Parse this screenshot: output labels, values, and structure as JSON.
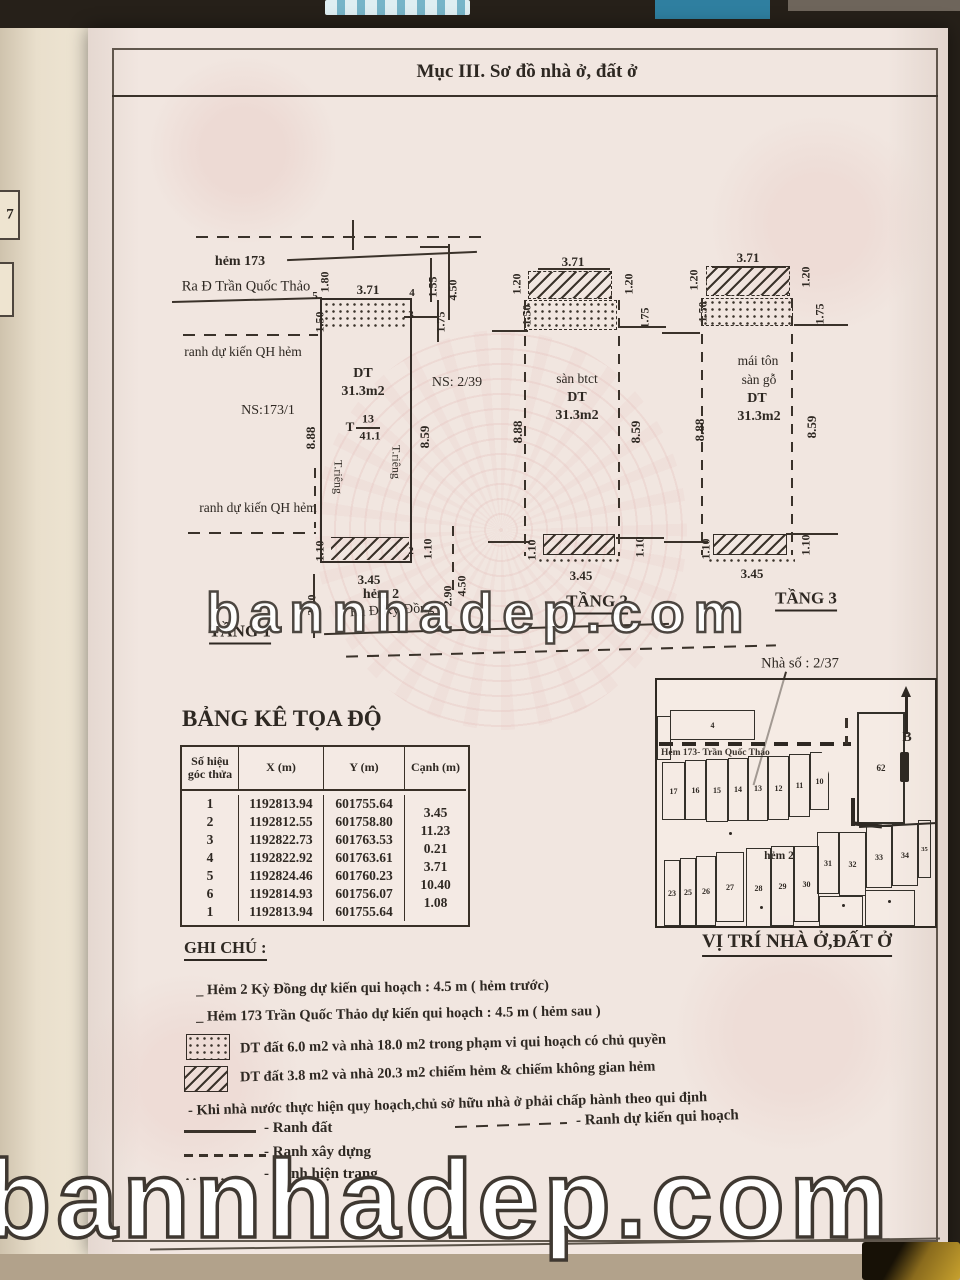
{
  "header": {
    "title": "Mục III. Sơ đồ nhà ở, đất ở"
  },
  "side_tab": {
    "page_number": "7"
  },
  "watermark": {
    "text": "bannhadep.com"
  },
  "floor1": {
    "title": "TẦNG 1",
    "alley_top": "hẻm 173",
    "alley_top_direction": "Ra Đ Trần Quốc Thảo",
    "boundary_top": "ranh dự kiến QH hẻm",
    "boundary_bottom": "ranh dự kiến QH hẻm",
    "ns_left": "NS:173/1",
    "ns_right": "NS: 2/39",
    "area_label": "DT",
    "area_value": "31.3m2",
    "lot_code": "T",
    "lot_number": "13",
    "lot_area": "41.1",
    "private_left": "T.riêng",
    "private_right": "T.riêng",
    "alley_bottom": "hẻm 2",
    "alley_bottom_direction": "Ra Đ Kỳ Đồng",
    "p5": "5",
    "p4": "4",
    "p3": "3",
    "p2": "2",
    "d_180": "1.80",
    "d_371": "3.71",
    "d_155": "1.55",
    "d_450": "4.50",
    "d_150": "1.50",
    "d_175": "1.75",
    "d_888": "8.88",
    "d_859": "8.59",
    "d_110l": "1.10",
    "d_345": "3.45",
    "d_110r": "1.10",
    "d_320": "3.20",
    "d_450b": "4.50",
    "d_290": "2.90"
  },
  "floor2": {
    "title": "TẦNG 2",
    "material": "sàn btct",
    "area_label": "DT",
    "area_value": "31.3m2",
    "d_371": "3.71",
    "d_120l": "1.20",
    "d_150": "1.50",
    "d_120r": "1.20",
    "d_175": "1.75",
    "d_888": "8.88",
    "d_859": "8.59",
    "d_110l": "1.10",
    "d_345": "3.45",
    "d_110r": "1.10"
  },
  "floor3": {
    "title": "TẦNG 3",
    "material1": "mái tôn",
    "material2": "sàn gỗ",
    "area_label": "DT",
    "area_value": "31.3m2",
    "d_371": "3.71",
    "d_120l": "1.20",
    "d_150": "1.50",
    "d_120r": "1.20",
    "d_175": "1.75",
    "d_888": "8.88",
    "d_859": "8.59",
    "d_110l": "1.10",
    "d_345": "3.45",
    "d_110r": "1.10"
  },
  "coords_table": {
    "heading": "BẢNG KÊ TỌA ĐỘ",
    "headers": {
      "id": "Số hiệu góc thửa",
      "x": "X (m)",
      "y": "Y (m)",
      "edge": "Cạnh (m)"
    },
    "rows": [
      {
        "id": "1",
        "x": "1192813.94",
        "y": "601755.64",
        "edge": ""
      },
      {
        "id": "2",
        "x": "1192812.55",
        "y": "601758.80",
        "edge": "3.45"
      },
      {
        "id": "3",
        "x": "1192822.73",
        "y": "601763.53",
        "edge": "11.23"
      },
      {
        "id": "4",
        "x": "1192822.92",
        "y": "601763.61",
        "edge": "0.21"
      },
      {
        "id": "5",
        "x": "1192824.46",
        "y": "601760.23",
        "edge": "3.71"
      },
      {
        "id": "6",
        "x": "1192814.93",
        "y": "601756.07",
        "edge": "10.40"
      },
      {
        "id": "1",
        "x": "1192813.94",
        "y": "601755.64",
        "edge": "1.08"
      }
    ]
  },
  "notes": {
    "heading": "GHI CHÚ :",
    "line_alley_front": "_ Hẻm 2 Kỳ Đồng dự kiến qui hoạch : 4.5 m  ( hẻm trước)",
    "line_alley_back": "_ Hẻm 173 Trần Quốc Thảo  dự kiến qui hoạch : 4.5 m   ( hẻm sau )",
    "legend_dotted": "DT đất 6.0 m2 và nhà 18.0 m2  trong phạm vi qui hoạch có chủ quyền",
    "legend_hatched": "DT đất 3.8 m2 và nhà  20.3 m2  chiếm hẻm & chiếm không gian hẻm",
    "compliance": "- Khi nhà nước thực hiện quy hoạch,chủ sở hữu nhà ở phải chấp hành theo qui định",
    "legend_land": "- Ranh đất",
    "legend_planning": "- Ranh dự kiến qui hoạch",
    "legend_construction": "- Ranh xây dựng",
    "legend_existing": "- Ranh hiện trạng"
  },
  "location_map": {
    "house_number": "Nhà số : 2/37",
    "title": "VỊ TRÍ NHÀ Ở,ĐẤT Ở",
    "street": "Hẻm 173- Trần Quốc Thảo",
    "alley": "hẻm 2",
    "north": "B",
    "parcels": {
      "n4": "4",
      "n17": "17",
      "n16": "16",
      "n15": "15",
      "n14": "14",
      "n13": "13",
      "n12": "12",
      "n11": "11",
      "n10": "10",
      "n62": "62",
      "n23": "23",
      "n25": "25",
      "n26": "26",
      "n27": "27",
      "n28": "28",
      "n29": "29",
      "n30": "30",
      "n31": "31",
      "n32": "32",
      "n33": "33",
      "n34": "34",
      "n35": "35"
    }
  },
  "colors": {
    "paper": "#f1e6e0",
    "ink": "#3a322a",
    "pattern_pink": "#e3bcbc",
    "watermark_fill": "#ffffff",
    "watermark_outline": "#46403a"
  }
}
